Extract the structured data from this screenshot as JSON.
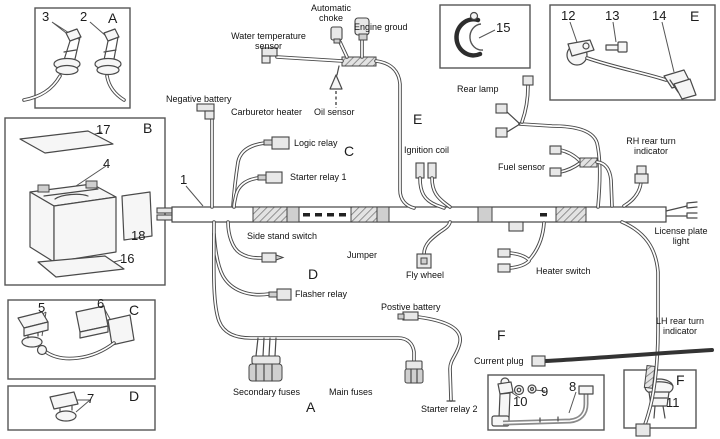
{
  "figure": {
    "background": "#ffffff",
    "line_color": "#4a4a4a"
  },
  "insets": {
    "spark_plugs": {
      "letter": "A",
      "num_3": "3",
      "num_2": "2"
    },
    "battery": {
      "letter": "B",
      "num_17": "17",
      "num_4": "4",
      "num_18": "18",
      "num_16": "16"
    },
    "relays_c": {
      "letter": "C",
      "num_5": "5",
      "num_6": "6"
    },
    "relay_d": {
      "letter": "D",
      "num_7": "7"
    },
    "clamp": {
      "num_15": "15"
    },
    "sensor_e": {
      "letter": "E",
      "num_12": "12",
      "num_13": "13",
      "num_14": "14"
    },
    "bracket_f": {
      "num_10": "10",
      "num_9": "9",
      "num_8": "8"
    },
    "indicator_f": {
      "letter": "F",
      "num_11": "11"
    }
  },
  "harness": {
    "num_1": "1",
    "section_c": "C",
    "section_d": "D",
    "section_e": "E",
    "section_a": "A",
    "section_f": "F",
    "labels": {
      "automatic_choke": "Automatic choke",
      "engine_ground": "Engine groud",
      "water_temp_sensor": "Water temperature sensor",
      "negative_battery": "Negative battery",
      "carburetor_heater": "Carburetor heater",
      "oil_sensor": "Oil sensor",
      "logic_relay": "Logic relay",
      "starter_relay_1": "Starter relay 1",
      "side_stand_switch": "Side stand switch",
      "jumper": "Jumper",
      "fly_wheel": "Fly wheel",
      "flasher_relay": "Flasher relay",
      "positive_battery": "Postive battery",
      "secondary_fuses": "Secondary fuses",
      "main_fuses": "Main fuses",
      "starter_relay_2": "Starter relay 2",
      "current_plug": "Current plug",
      "rear_lamp": "Rear lamp",
      "ignition_coil": "Ignition coil",
      "fuel_sensor": "Fuel sensor",
      "rh_rear_turn_indicator": "RH rear turn indicator",
      "license_plate_light": "License plate light",
      "heater_switch": "Heater switch",
      "lh_rear_turn_indicator": "LH rear turn indicator"
    }
  }
}
